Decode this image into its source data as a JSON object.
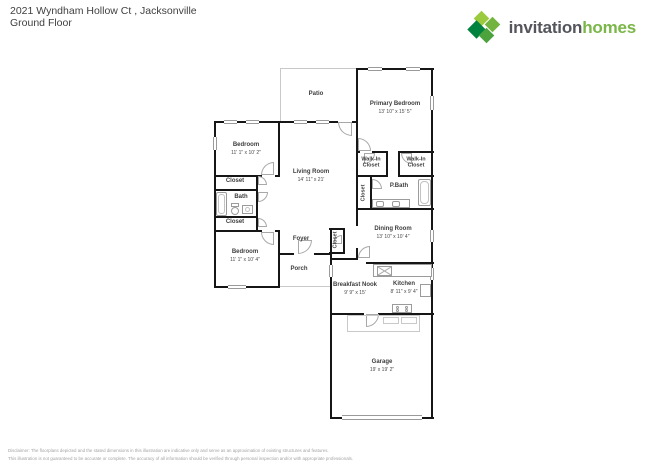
{
  "header": {
    "address": "2021 Wyndham Hollow Ct , Jacksonville",
    "floor": "Ground Floor"
  },
  "logo": {
    "word1": "invitation",
    "word2": "homes",
    "colors": {
      "word1": "#54565b",
      "word2": "#7ab648",
      "diamond_light": "#9bca3e",
      "diamond_bright": "#72b43e",
      "diamond_dark": "#00833e",
      "diamond_mid": "#4ca23d"
    }
  },
  "rooms": {
    "patio": {
      "name": "Patio"
    },
    "primary_bedroom": {
      "name": "Primary Bedroom",
      "dims": "13' 10\" x 15' 5\""
    },
    "bedroom_top": {
      "name": "Bedroom",
      "dims": "11' 1\" x 10' 2\""
    },
    "living_room": {
      "name": "Living Room",
      "dims": "14' 11\" x 21'"
    },
    "walkin_closet_left": {
      "name": "Walk-In Closet"
    },
    "walkin_closet_right": {
      "name": "Walk-In Closet"
    },
    "pbath_closet": {
      "name": "Closet"
    },
    "pbath": {
      "name": "P.Bath"
    },
    "dining_room": {
      "name": "Dining Room",
      "dims": "13' 10\" x 10' 4\""
    },
    "closet_hall_top": {
      "name": "Closet"
    },
    "bath": {
      "name": "Bath"
    },
    "closet_hall_bottom": {
      "name": "Closet"
    },
    "bedroom_bottom": {
      "name": "Bedroom",
      "dims": "11' 1\" x 10' 4\""
    },
    "foyer": {
      "name": "Foyer"
    },
    "foyer_closet": {
      "name": "Closet"
    },
    "porch": {
      "name": "Porch"
    },
    "breakfast_nook": {
      "name": "Breakfast Nook",
      "dims": "9' 9\" x 15'"
    },
    "kitchen": {
      "name": "Kitchen",
      "dims": "8' 11\" x 9' 4\""
    },
    "garage": {
      "name": "Garage",
      "dims": "19' x 19' 2\""
    }
  },
  "disclaimer": {
    "line1": "Disclaimer: The floorplans depicted and the stated dimensions in this illustration are indicative only and serve as an approximation of existing structures and features.",
    "line2": "This illustration is not guaranteed to be accurate or complete. The accuracy of all information should be verified through personal inspection and/or with appropriate professionals."
  }
}
